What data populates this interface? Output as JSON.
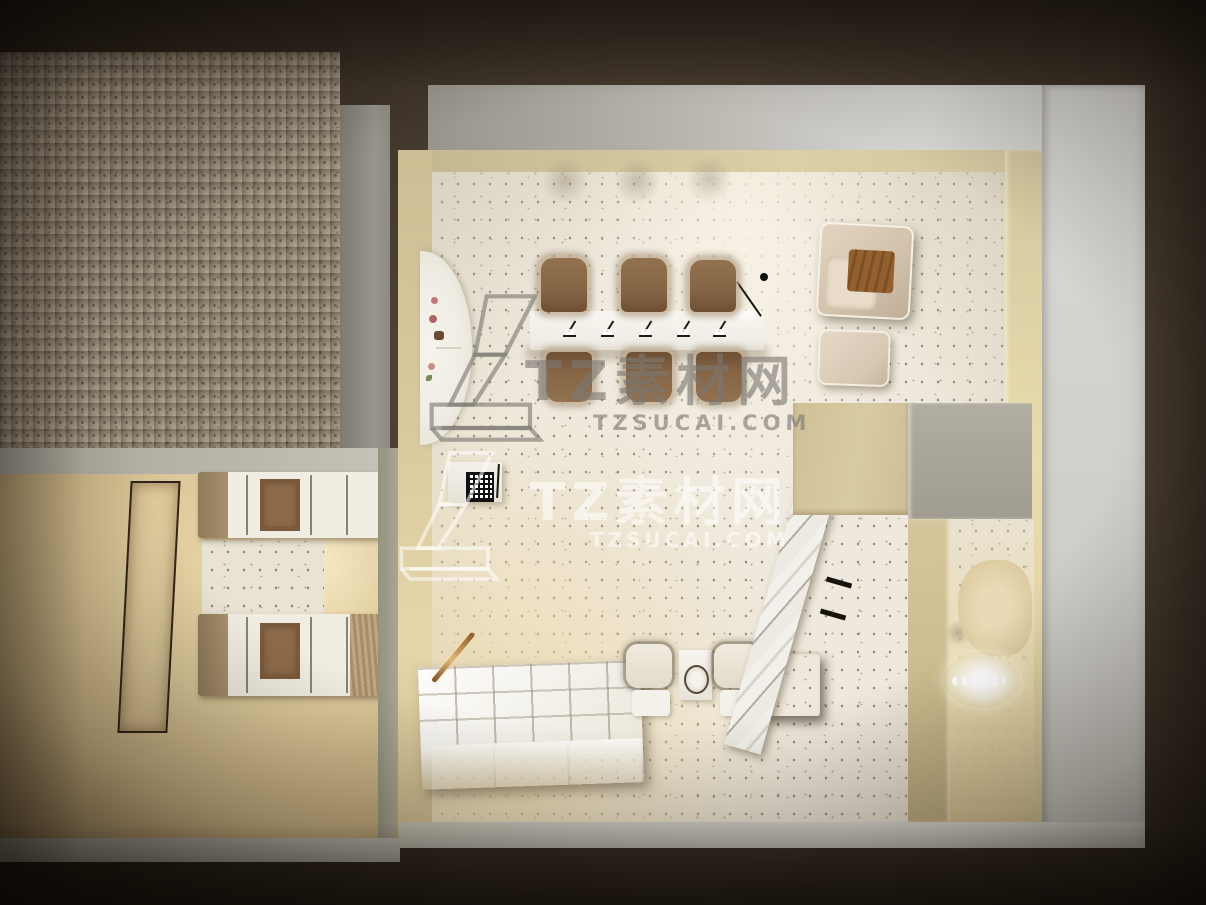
{
  "meta": {
    "title": "Top-down 3D render of a nail salon interior",
    "render_style": "bird's-eye cutaway 3D visualization, beige and cream palette, terrazzo floors"
  },
  "watermark": {
    "brand_cjk": "TZ素材网",
    "brand_domain": "TZSUCAI.COM",
    "logo_glyph": "1",
    "instances": [
      {
        "position": "center-upper",
        "tone": "gray"
      },
      {
        "position": "center-lower",
        "tone": "white"
      }
    ]
  },
  "palette": {
    "exterior_dark": "#2b241d",
    "roof_speckle": "#988c7d",
    "wall_gray": "#908c84",
    "wall_white": "#d7d6d2",
    "wall_beige": "#d2c49c",
    "floor_terrazzo": "#efe9dd",
    "floor_beige": "#dcc89a",
    "chair_brown": "#8a6a4a",
    "armchair_beige": "#d3c2ac",
    "blanket_brown": "#93602f",
    "cabinet_dark": "#231a11",
    "copper_rail": "#c08a46",
    "marble_white": "#f2f0ea"
  },
  "scene": {
    "rooms": [
      {
        "name": "manicure-salon",
        "floor": "white terrazzo"
      },
      {
        "name": "massage-room",
        "floor": "beige",
        "items": [
          "wall-art",
          "two massage beds"
        ]
      },
      {
        "name": "pedicure-nook",
        "floor": "beige",
        "items": [
          "pedicure chair",
          "sink",
          "bottles"
        ]
      }
    ],
    "furniture": [
      "manicure table with five desk lamps",
      "six brown fur-trimmed client chairs",
      "beige lounge armchair with brown throw and ottoman",
      "arched wall niche with flowers",
      "reception stand with QR sign",
      "white retail display shelf",
      "copper handrail",
      "two cream waiting chairs with mirror side table",
      "dark wood storage cabinet",
      "marble partition panel with black brackets"
    ]
  }
}
